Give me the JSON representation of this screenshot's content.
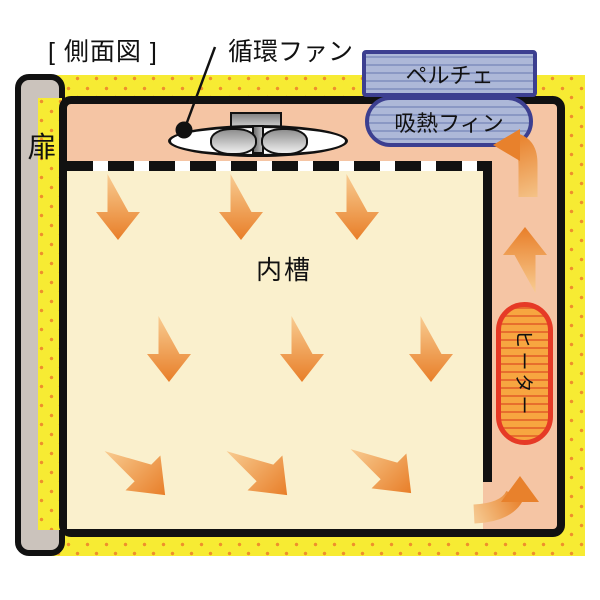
{
  "diagram": {
    "title": "[ 側面図 ]",
    "labels": {
      "circulation_fan": "循環ファン",
      "peltier": "ペルチェ",
      "heat_absorption_fin": "吸熱フィン",
      "inner_tank": "内槽",
      "heater": "ヒーター",
      "door": "扉"
    },
    "colors": {
      "insulation_yellow": "#f7eb33",
      "insulation_dot_orange": "#ee8f2c",
      "plenum_salmon": "#f5c5a4",
      "tank_cream": "#faf0cd",
      "airflow_arrow_orange": "#e8812c",
      "airflow_arrow_tail": "#f8cc92",
      "heater_fill": "#f7a640",
      "heater_border_red": "#e63a26",
      "peltier_fill": "#adb8d8",
      "peltier_border_navy": "#3c3f90",
      "door_gray": "#cbc3bc",
      "outline_black": "#111111"
    }
  }
}
